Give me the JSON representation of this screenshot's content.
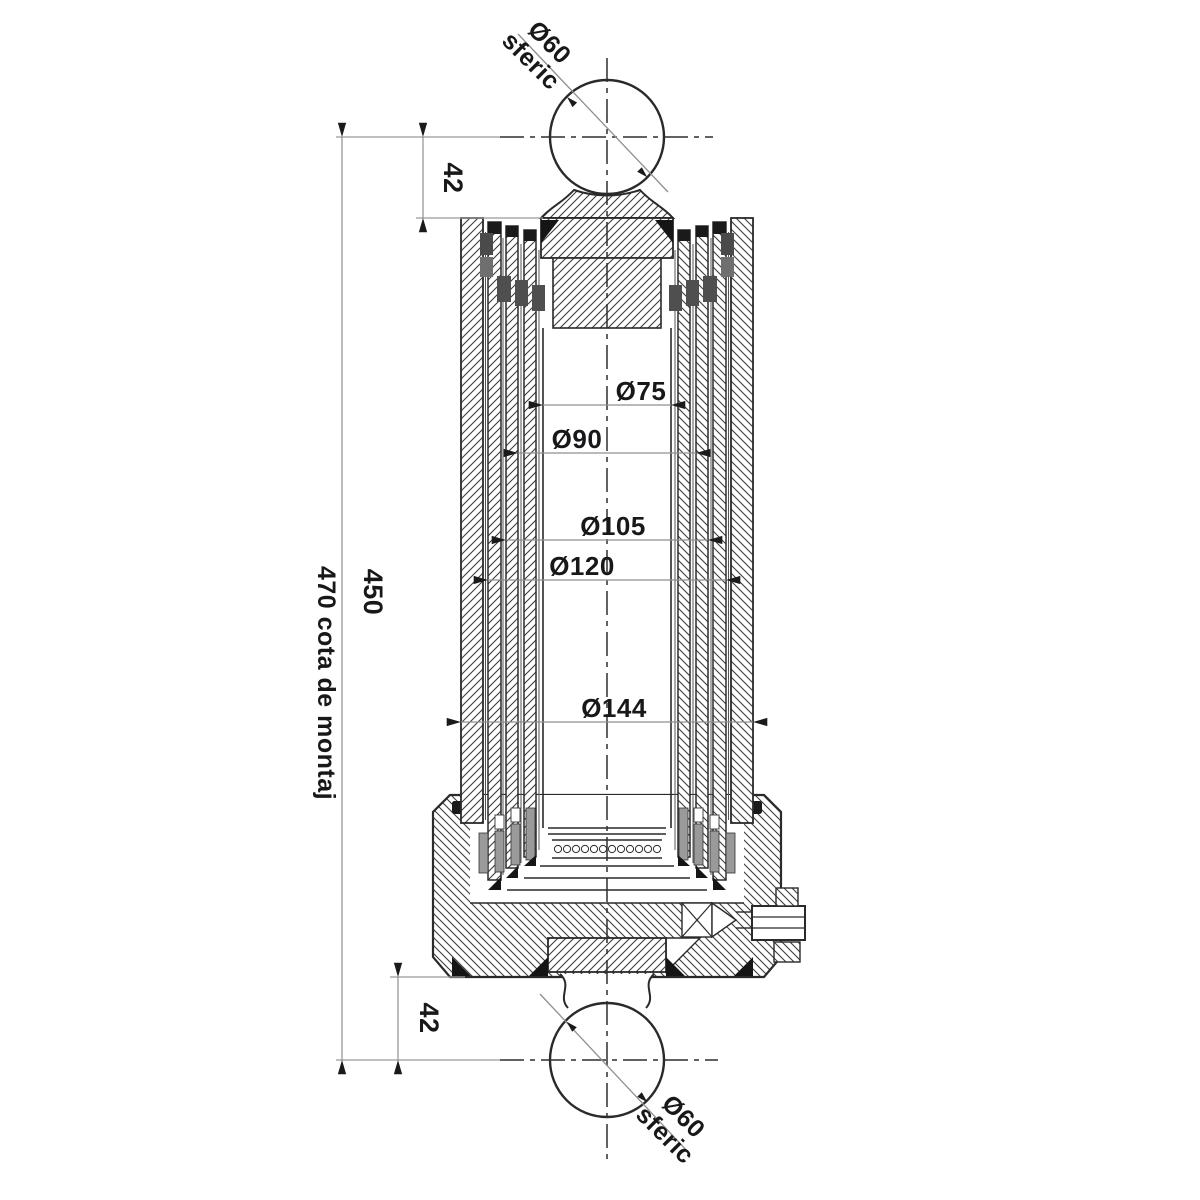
{
  "dims": {
    "stub_top": {
      "value": "42"
    },
    "stub_bottom": {
      "value": "42"
    },
    "length": {
      "value": "450"
    },
    "mounting": {
      "value": "470 cota de montaj"
    },
    "ball_top": {
      "d": "Ø60",
      "note": "sferic"
    },
    "ball_bottom": {
      "d": "Ø60",
      "note": "sferic"
    },
    "bores": [
      {
        "label": "Ø75"
      },
      {
        "label": "Ø90"
      },
      {
        "label": "Ø105"
      },
      {
        "label": "Ø120"
      },
      {
        "label": "Ø144"
      }
    ]
  },
  "colors": {
    "bg": "#ffffff",
    "line": "#2a2a2a",
    "dim": "#8f8f8f",
    "text": "#18181b",
    "seal-dark": "#1a1a1a",
    "seal-gray": "#6f6f6f"
  }
}
